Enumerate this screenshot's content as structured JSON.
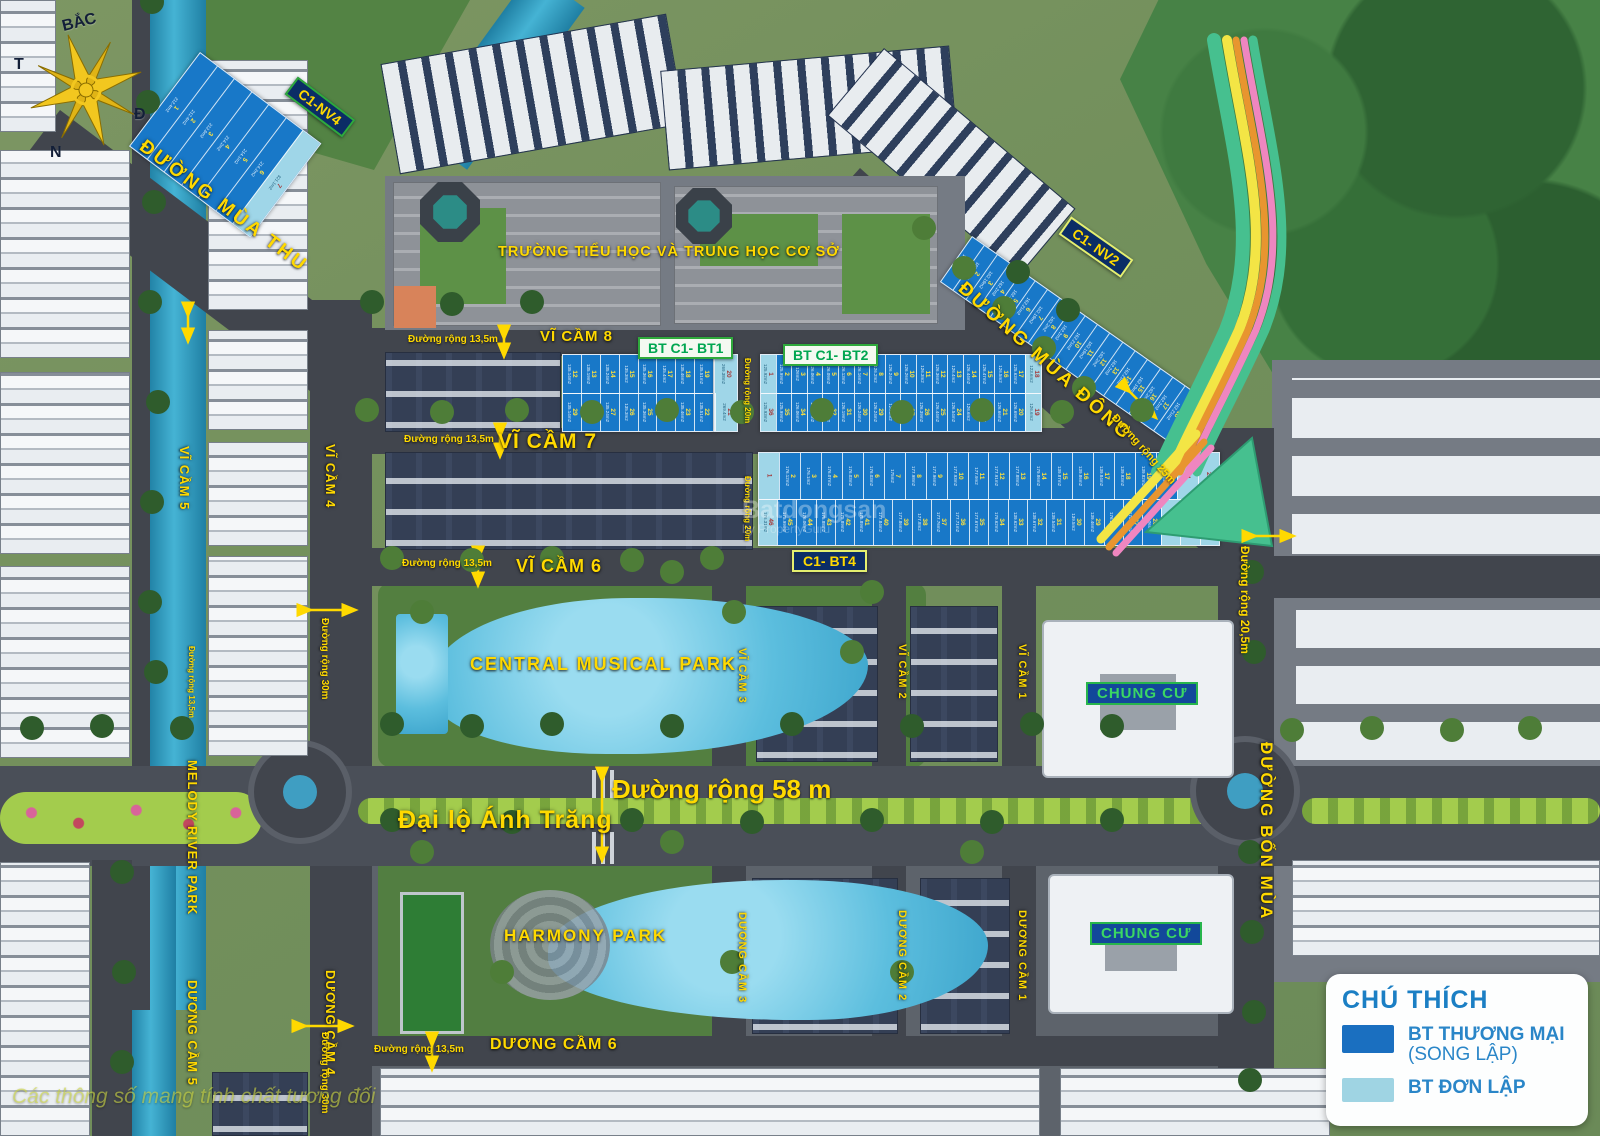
{
  "meta": {
    "width": 1600,
    "height": 1136
  },
  "compass": {
    "north": "BẮC",
    "west": "T",
    "east": "Đ",
    "south": "N"
  },
  "roads": {
    "mua_thu": "ĐƯỜNG MÙA THU",
    "mua_dong": "ĐƯỜNG MÙA ĐÔNG",
    "bon_mua": "ĐƯỜNG BỐN MÙA",
    "anh_trang": "Đại lộ Ánh Trăng"
  },
  "school": {
    "label": "TRƯỜNG TIỂU HỌC VÀ TRUNG HỌC CƠ SỞ"
  },
  "parks": {
    "central": "CENTRAL MUSICAL PARK",
    "harmony": "HARMONY PARK",
    "melody": "MELODY RIVER PARK"
  },
  "apartments": {
    "chung_cu_1": "CHUNG CƯ",
    "chung_cu_2": "CHUNG CƯ"
  },
  "zones": {
    "vc8": "VĨ CẦM 8",
    "vc7": "VĨ CẦM 7",
    "vc6": "VĨ CẦM 6",
    "vc5": "VĨ CẦM 5",
    "vc4": "VĨ CẦM 4",
    "vc3": "VĨ CẦM 3",
    "vc2": "VĨ CẦM 2",
    "vc1": "VĨ CẦM 1",
    "dc6": "DƯƠNG CẦM 6",
    "dc5": "DƯƠNG CẦM 5",
    "dc4": "DƯƠNG CẦM 4",
    "dc3": "DƯƠNG CẦM 3",
    "dc2": "DƯƠNG CẦM 2",
    "dc1": "DƯƠNG CẦM 1"
  },
  "block_tags": {
    "nv4": "C1-NV4",
    "nv2": "C1- NV2",
    "bt1": "BT C1- BT1",
    "bt2": "BT C1- BT2",
    "bt4": "C1- BT4"
  },
  "dims": {
    "d58": "Đường rộng 58 m",
    "d305": "Đường rộng 20,5m",
    "d30": "Đường rộng 30m",
    "d20": "Đường rộng 20m",
    "d135": "Đường rộng 13,5m",
    "d25": "Đường rộng 25m"
  },
  "legend": {
    "title": "CHÚ THÍCH",
    "items": [
      {
        "label": "BT THƯƠNG MẠI",
        "sublabel": "(SONG LẬP)",
        "color": "#1a6fc0"
      },
      {
        "label": "BT ĐƠN LẬP",
        "sublabel": "",
        "color": "#9fd4e3"
      }
    ]
  },
  "watermarks": {
    "corner": "Các thông số mang tính chất tương đối",
    "center_line1": "Batdongsan",
    "center_line2": "by PropertyGuru"
  },
  "colors": {
    "lot_dark": "#1878c8",
    "lot_light": "#9fd6e8",
    "label_yellow": "#ffd900",
    "tag_green": "#00a651",
    "legend_blue": "#2a86c8",
    "arrow_green": "#46c08f"
  },
  "lot_strips": {
    "nv4": {
      "from": 1,
      "to": 7,
      "light": [
        6
      ],
      "areas": [
        "212.4m2",
        "212.4m2",
        "212.6m2",
        "214.2m2",
        "214.1m2",
        "214.2m2",
        "321.1m2"
      ]
    },
    "nv2": {
      "from": 1,
      "to": 19,
      "light": [
        18
      ],
      "areas": [
        "162.2m2",
        "162.21m2",
        "162.19m2",
        "162.2m2"
      ]
    },
    "bt1_top": {
      "from": 12,
      "to": 19,
      "light": [],
      "areas": [
        "135.14m2",
        "135.19m2",
        "135.24m2",
        "135.3m2",
        "135.36m2",
        "135.4m2",
        "135.46m2",
        "135.51m2"
      ]
    },
    "bt1_bot": {
      "from": 29,
      "to": 22,
      "light": [],
      "areas": [
        "135.14m2",
        "135.19m2",
        "135.24m2",
        "135.3m2",
        "135.36m2",
        "135.4m2",
        "135.46m2",
        "135.51m2"
      ]
    },
    "bt1_end": {
      "numbers": [
        20,
        21
      ],
      "light": [
        0,
        1
      ],
      "areas": [
        "269.38m2",
        "269.4m2"
      ]
    },
    "bt2_top": {
      "from": 1,
      "to": 18,
      "light": [
        0,
        17
      ],
      "areas": [
        "125.92m2",
        "125.99m2",
        "126m2",
        "126.06m2",
        "126.09m2",
        "126.13m2",
        "126.16m2",
        "126.2m2",
        "126.24m2",
        "126.26m2",
        "126.3m2",
        "126.36m2",
        "126.4m2",
        "126.44m2",
        "126.47m2",
        "126.5m2",
        "125.63m2",
        "123.6m2"
      ]
    },
    "bt2_bot": {
      "from": 36,
      "to": 19,
      "light": [
        0,
        17
      ],
      "areas": [
        "125.93m2",
        "125.99m2",
        "126.06m2",
        "126.09m2",
        "126.13m2",
        "126.19m2",
        "126.24m2",
        "126.24m2",
        "126.3m2",
        "126.34m2",
        "126.39m2",
        "126.44m2",
        "126.54m2",
        "126.6m2",
        "126.64m2",
        "126.66m2",
        "126.69m2",
        "126.6m2"
      ]
    },
    "bt4_top": {
      "from": 1,
      "to": 22,
      "light": [
        0,
        20,
        21
      ],
      "areas": [
        "",
        "176.12m2",
        "176.1m2",
        "176.07m2",
        "176.03m2",
        "176.03m2",
        "175m2",
        "177.98m2",
        "177.96m2",
        "177.93m2",
        "177.9m2",
        "177.91m2",
        "177.88m2",
        "179.86m2",
        "139.87m2",
        "139.86m2",
        "139.84m2",
        "139.83m2",
        "139.82m2",
        "139.8m2",
        "",
        ""
      ]
    },
    "bt4_bot": {
      "from": 46,
      "to": 23,
      "light": [
        0,
        21,
        22,
        23
      ],
      "areas": [
        "176.31m2",
        "175.99m2",
        "176.06m2",
        "175.88m2",
        "175.89m2",
        "175.89m2",
        "177.84m2",
        "177.86m2",
        "177.8m2",
        "177.76m2",
        "177.71m2",
        "177.67m2",
        "179.62m2",
        "139.62m2",
        "139.67m2",
        "139.54m2",
        "139.5m2",
        "139.46m2"
      ]
    }
  }
}
